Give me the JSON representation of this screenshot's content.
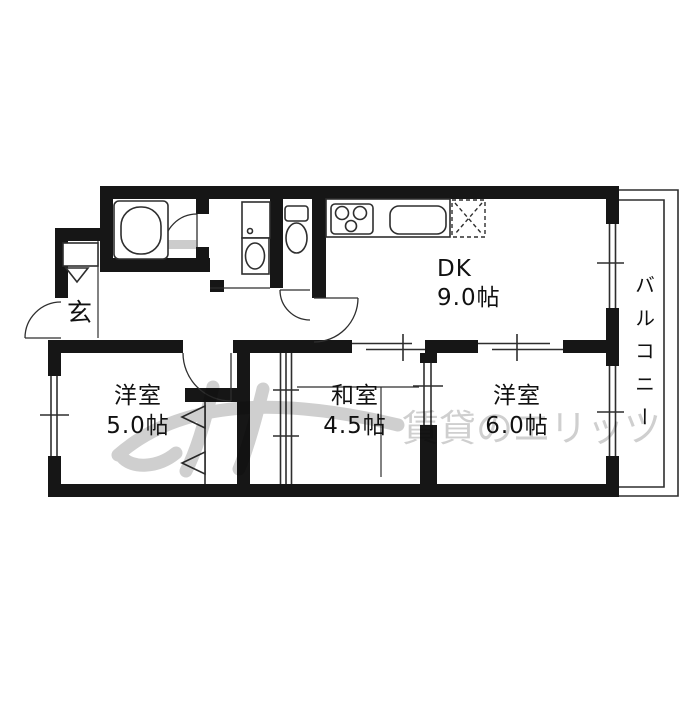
{
  "rooms": {
    "dk": {
      "name": "DK",
      "area": "9.0帖"
    },
    "western_5": {
      "name": "洋室",
      "area": "5.0帖"
    },
    "japanese_45": {
      "name": "和室",
      "area": "4.5帖"
    },
    "western_6": {
      "name": "洋室",
      "area": "6.0帖"
    },
    "entrance": {
      "name": "玄"
    },
    "balcony": {
      "name": "バルコニー"
    }
  },
  "fixtures": {
    "bathtub": "bathtub-icon",
    "kitchen_stove": "stove-icon",
    "kitchen_sink": "sink-icon",
    "refrigerator_space": "refrigerator-space-icon",
    "washbasin": "washbasin-icon",
    "toilet": "toilet-icon",
    "shoe_cabinet": "shoe-cabinet-icon"
  },
  "watermark": {
    "text": "賃貸のエリッツ"
  },
  "colors": {
    "wall": "#161616",
    "line": "#2e2e2e",
    "background": "#ffffff",
    "watermark": "#c3c3c3"
  }
}
